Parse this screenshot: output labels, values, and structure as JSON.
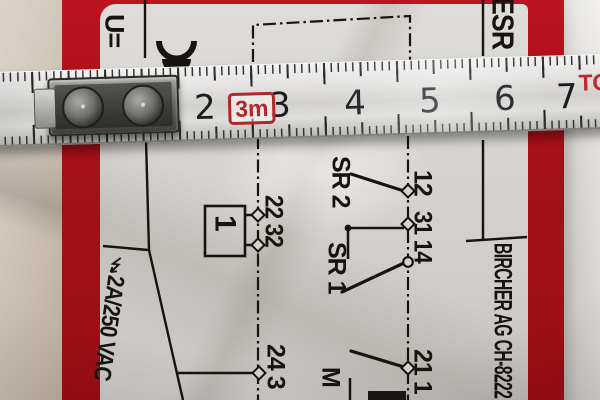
{
  "device": {
    "type_label": "ESR",
    "voltage_symbol": "U=",
    "rating_label": "2A/250 VAC",
    "manufacturer_label": "BIRCHER AG CH-8222",
    "diagram": {
      "box_label": "1",
      "sr2_label": "SR 2",
      "sr1_label": "SR 1",
      "motor_label": "M",
      "terminals_right_top": "12",
      "terminals_right_mid": "31 14",
      "terminals_left": "22 32",
      "terminals_bottom_left": "24 3",
      "terminals_bottom_right": "21 1"
    }
  },
  "ruler": {
    "cm_marks": [
      "2",
      "3",
      "4",
      "5",
      "6",
      "7"
    ],
    "length_badge": "3m",
    "brand_fragment": "TO"
  },
  "colors": {
    "device_red": "#a81018",
    "ruler_badge_red": "#b3262a",
    "ruler_brand_red": "#c1272d",
    "label_background": "#d6d4d0"
  }
}
